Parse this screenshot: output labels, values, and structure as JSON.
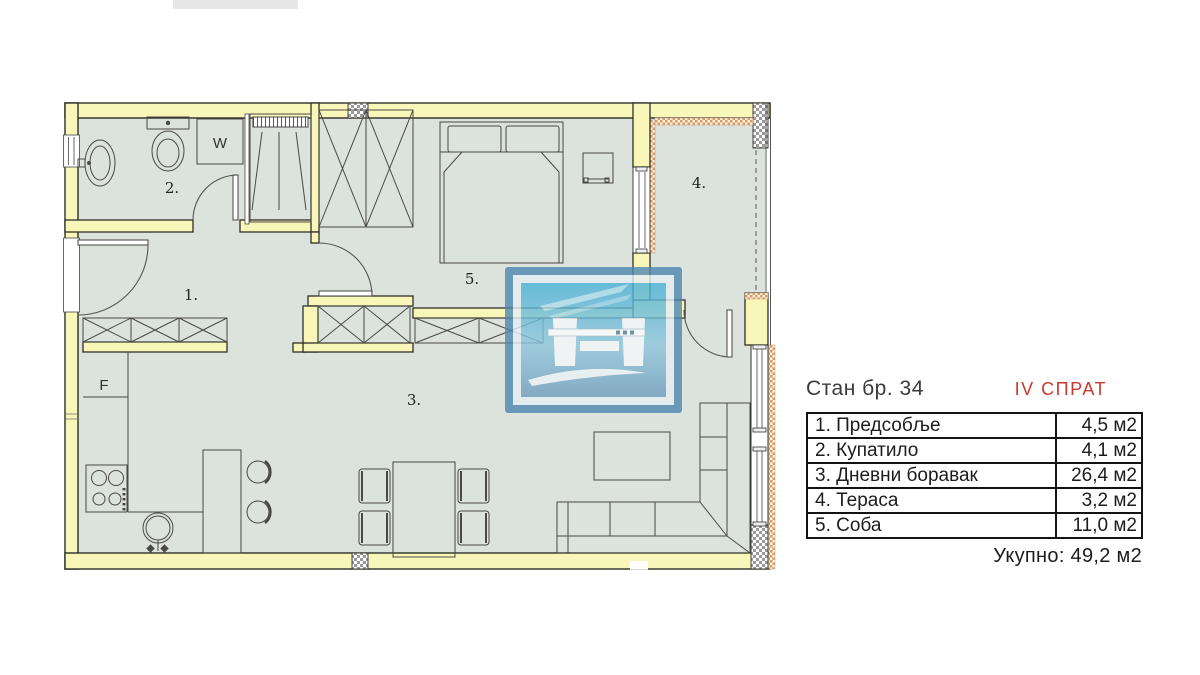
{
  "palette": {
    "wall_fill": "#f9f6ba",
    "floor_fill": "#dce2dc",
    "outline": "#2f2f28",
    "accent_red": "#c9392e",
    "watermark_blue": "#4e88af",
    "insulation_orange": "#dd9a63"
  },
  "plan": {
    "room_labels": [
      {
        "room": "hallway",
        "text": "1."
      },
      {
        "room": "bathroom",
        "text": "2."
      },
      {
        "room": "living",
        "text": "3."
      },
      {
        "room": "terrace",
        "text": "4."
      },
      {
        "room": "bedroom",
        "text": "5."
      }
    ],
    "fixture_labels": [
      {
        "fixture": "washing-machine",
        "text": "W"
      },
      {
        "fixture": "fridge",
        "text": "F"
      }
    ]
  },
  "info_panel": {
    "title": "Стан бр. 34",
    "floor": "IV СПРАТ",
    "rows": [
      {
        "label": "1. Предсобље",
        "area": "4,5 м2"
      },
      {
        "label": "2. Купатило",
        "area": "4,1 м2"
      },
      {
        "label": "3. Дневни боравак",
        "area": "26,4 м2"
      },
      {
        "label": "4. Тераса",
        "area": "3,2 м2"
      },
      {
        "label": "5. Соба",
        "area": "11,0 м2"
      }
    ],
    "total": "Укупно: 49,2 м2"
  }
}
